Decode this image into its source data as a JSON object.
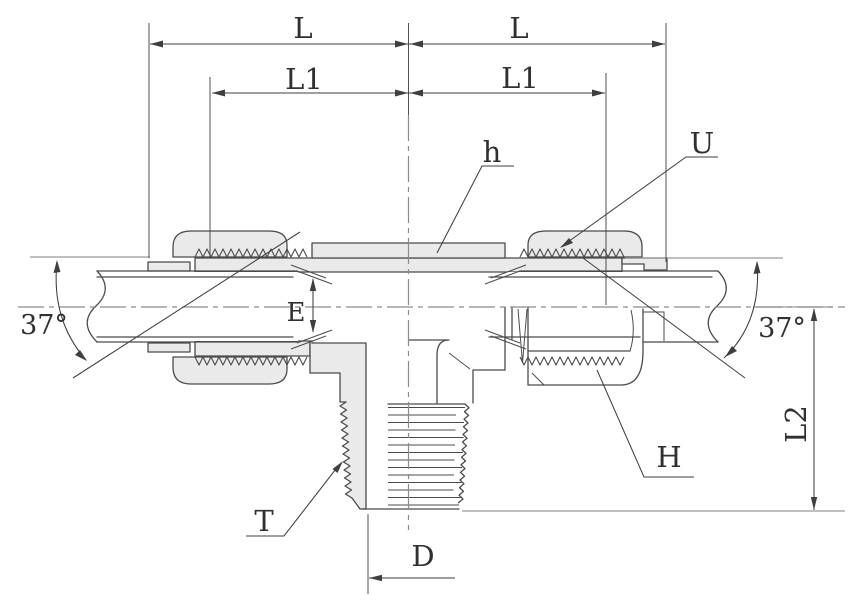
{
  "drawing": {
    "subject": "37-degree flare male branch tee fitting - dimensioned section drawing",
    "colors": {
      "line": "#4b4b4b",
      "dim": "#3f3f3f",
      "fill": "#eaeaea",
      "cl": "#8c8c8c",
      "ref": "#9a9a9a",
      "bg": "#ffffff",
      "txt": "#303030"
    },
    "dim_labels": {
      "l_left": "L",
      "l_right": "L",
      "l1_left": "L1",
      "l1_right": "L1",
      "e": "E",
      "d": "D",
      "l2": "L2",
      "angle_left": "37°",
      "angle_right": "37°"
    },
    "part_labels": {
      "hex_body": "h",
      "nut_thread": "U",
      "pipe_thread": "T",
      "nut_height": "H"
    }
  }
}
